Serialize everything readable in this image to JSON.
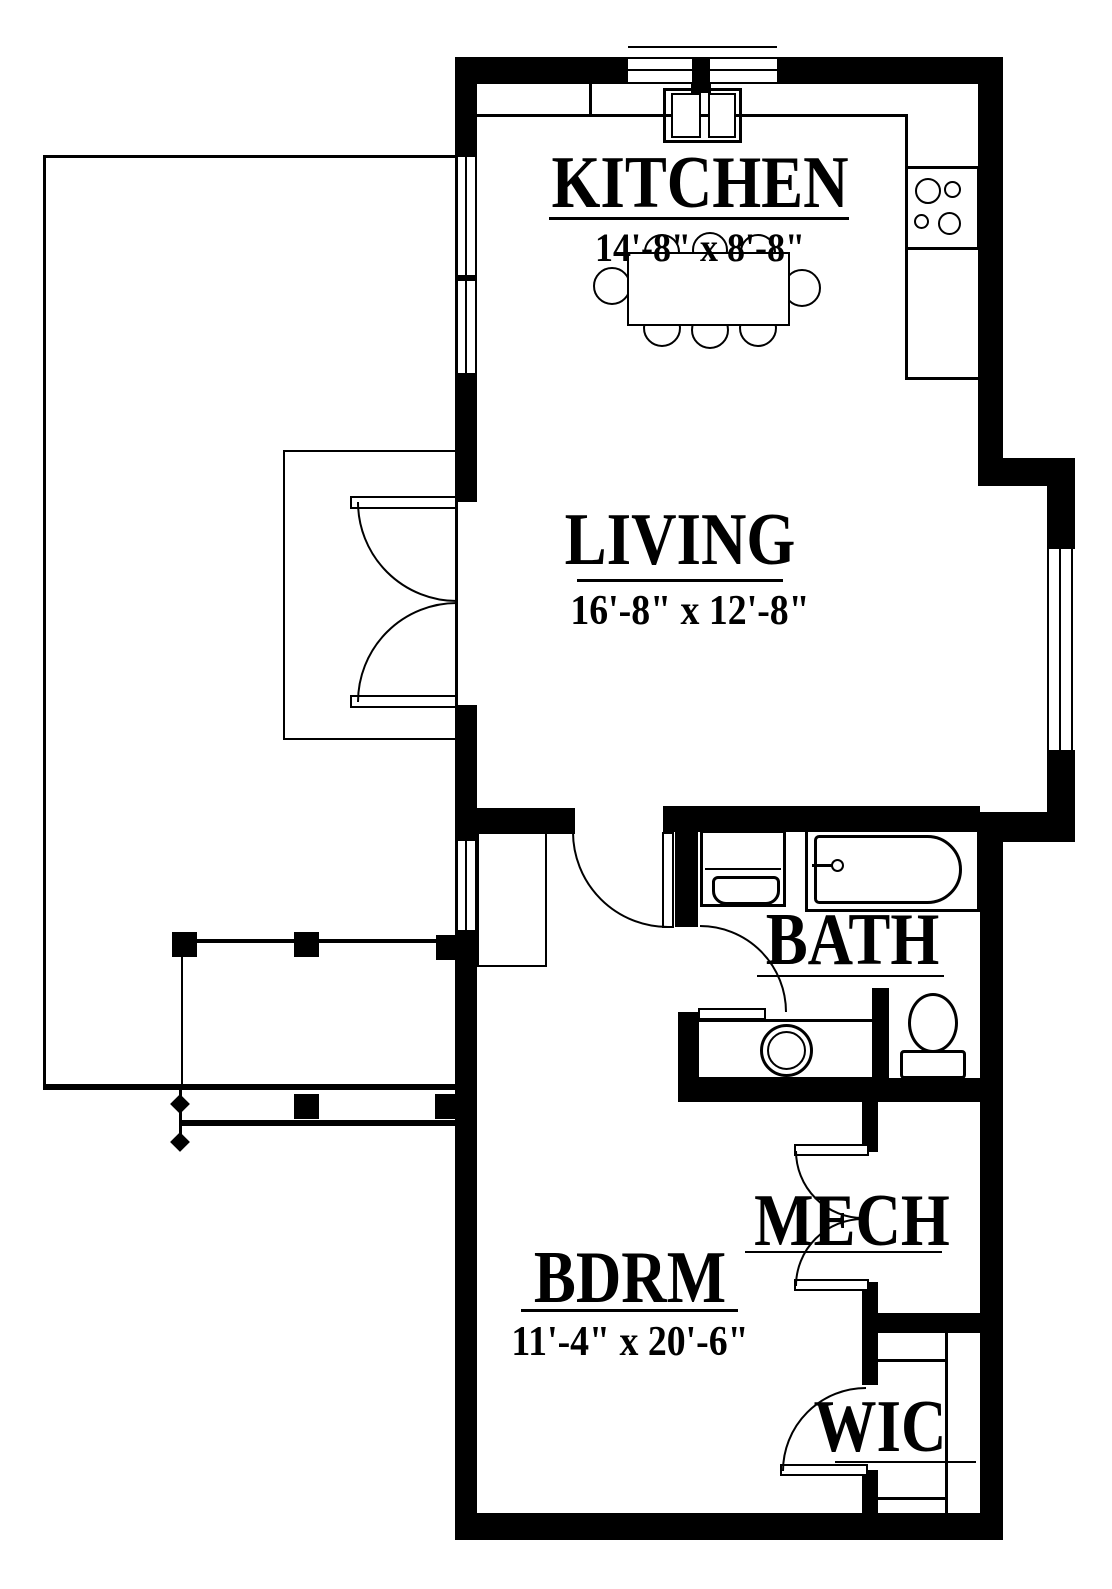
{
  "document": {
    "type": "architectural floor plan",
    "colors": {
      "line": "#000000",
      "background": "#ffffff"
    }
  },
  "rooms": {
    "kitchen": {
      "label": "KITCHEN",
      "dims": "14'-8\" x 8'-8\""
    },
    "living": {
      "label": "LIVING",
      "dims": "16'-8\" x 12'-8\""
    },
    "bath": {
      "label": "BATH"
    },
    "bedroom": {
      "label": "BDRM",
      "dims": "11'-4\" x 20'-6\""
    },
    "mech": {
      "label": "MECH"
    },
    "wic": {
      "label": "WIC"
    }
  }
}
